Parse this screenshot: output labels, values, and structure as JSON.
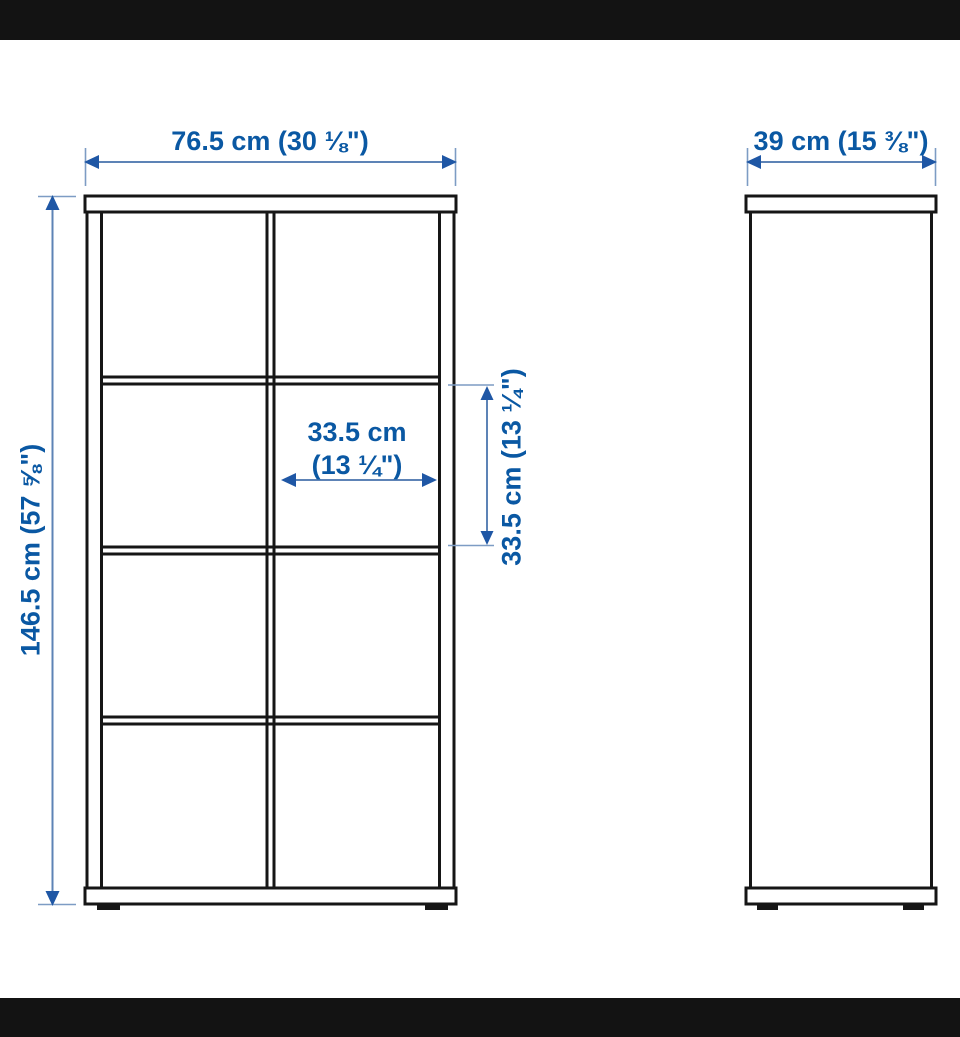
{
  "diagram": {
    "product_type": "cube shelving unit, 2x4 compartments, front and side views",
    "front_view": {
      "width_label": "76.5 cm (30 ⅛\")",
      "height_label": "146.5 cm (57 ⅝\")",
      "inner_width_label_line1": "33.5 cm",
      "inner_width_label_line2": "(13 ¼\")",
      "inner_height_label": "33.5 cm (13 ¼\")"
    },
    "side_view": {
      "depth_label": "39 cm (15 ⅜\")"
    },
    "colors": {
      "label_text": "#0a58a3",
      "dimension_line": "#5d83b6",
      "arrowhead": "#1f57a5",
      "outline": "#161616",
      "letterbox": "#131313",
      "background": "#ffffff"
    }
  }
}
